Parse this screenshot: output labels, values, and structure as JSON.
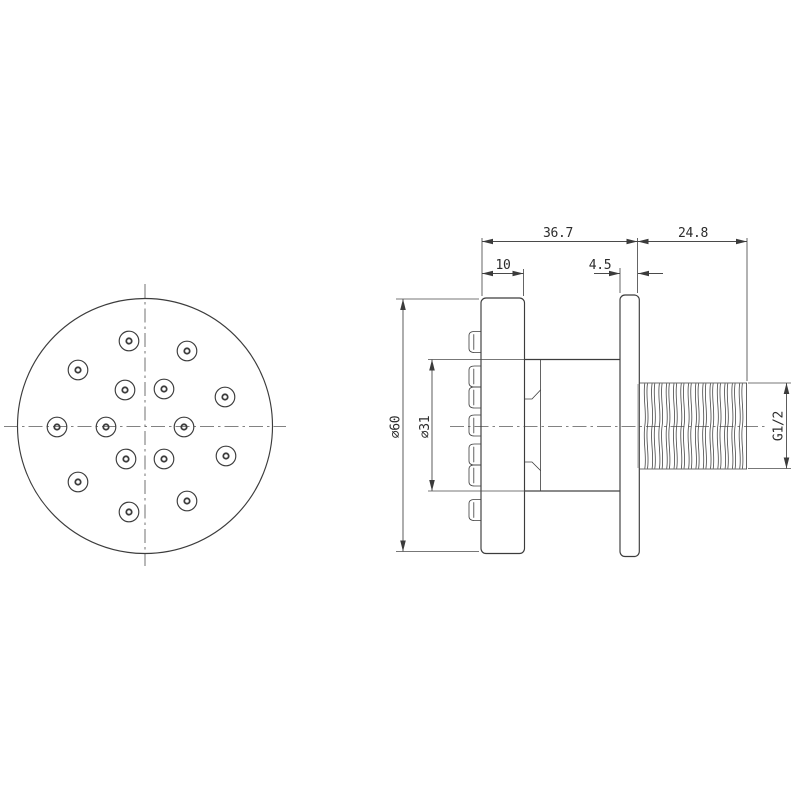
{
  "drawing": {
    "front_view": {
      "nozzle_count": 15
    },
    "dimensions": {
      "overall_depth": "36.7",
      "thread_length": "24.8",
      "faceplate_thickness": "10",
      "flange_thickness": "4.5",
      "face_diameter": "∅60",
      "body_diameter": "∅31",
      "thread_spec": "G1/2"
    },
    "colors": {
      "line": "#3c3c3c",
      "background": "#ffffff"
    }
  }
}
